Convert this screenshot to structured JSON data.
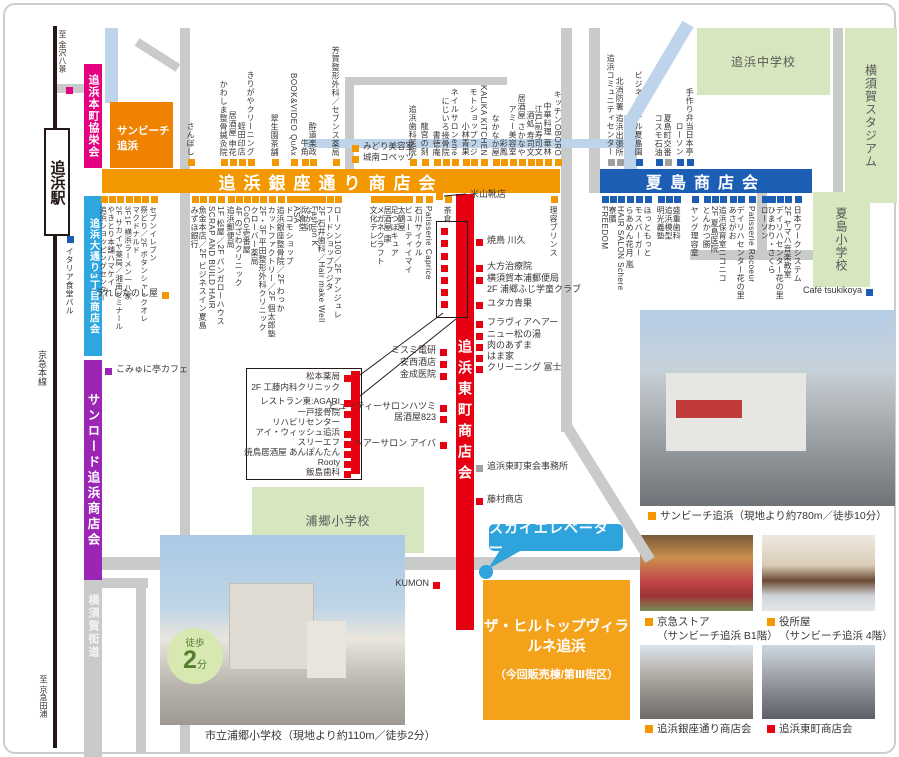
{
  "railway": {
    "dest_top": "至 金沢八景",
    "station": "追浜駅",
    "line": "京急本線",
    "dest_bottom": "至 京急田浦"
  },
  "banners": {
    "honcho": "追浜本町協栄会",
    "sunbeach_l1": "サンビーチ",
    "sunbeach_l2": "追浜",
    "ginza": "追浜銀座通り商店会",
    "natsushima": "夏島商店会",
    "odori": "追浜大通り3丁目商店会",
    "sunroad": "サンロード追浜商店会",
    "kaido": "横須賀街道",
    "higashicho": "追浜東町商店会"
  },
  "areas": {
    "junior_high": "追浜中学校",
    "stadium": "横須賀スタジアム",
    "natsushima_elem": "夏島小学校",
    "urago_elem": "浦郷小学校"
  },
  "callouts": {
    "sky_elevator": "スカイエレベーター",
    "property_l1": "ザ・ヒルトップヴィラ",
    "property_l2": "ルネ追浜",
    "property_l3": "（今回販売棟/第Ⅲ街区）"
  },
  "photos": {
    "main_caption": "サンビーチ追浜（現地より約780m／徒歩10分）",
    "keikyu_l1": "京急ストア",
    "keikyu_l2": "（サンビーチ追浜 B1階）",
    "yakusho_l1": "役所屋",
    "yakusho_l2": "（サンビーチ追浜 4階）",
    "ginza_caption": "追浜銀座通り商店会",
    "higashi_caption": "追浜東町商店会",
    "school_caption": "市立浦郷小学校（現地より約110m／徒歩2分）",
    "badge_walk": "徒歩",
    "badge_num": "2",
    "badge_min": "分"
  },
  "colors": {
    "ginza_orange": "#F39800",
    "natsushima_blue": "#1C5EB4",
    "higashicho_red": "#E60012",
    "odori_lightblue": "#2EA7E0",
    "sunroad_purple": "#9B26B5",
    "honcho_magenta": "#E4007F",
    "road_gray": "#C9CACA",
    "water_blue": "#BDD4EA",
    "school_green": "#D6E6BE",
    "callout_blue": "#2EA3DC",
    "property_orange": "#F5A21B",
    "marker_gray": "#9FA0A0"
  },
  "shop_groups": [
    {
      "id": "ginza-north",
      "type": "v-up",
      "sq": "#F39800",
      "fs": 8,
      "sq_y": 159,
      "text_y": 156,
      "items": [
        {
          "t": "さんぼし",
          "x": 188
        },
        {
          "t": "かわしま整骨鍼灸院",
          "x": 221
        },
        {
          "t": "居酒屋 申花",
          "x": 230
        },
        {
          "t": "蛭田印店",
          "x": 239
        },
        {
          "t": "きりがやクリーニング",
          "x": 248
        },
        {
          "t": "翠生園茶舗",
          "x": 272
        },
        {
          "t": "BOOK&VIDEO QuAx",
          "x": 291
        },
        {
          "t": "牛角",
          "x": 302
        },
        {
          "t": "酔道楽政",
          "x": 310
        },
        {
          "t": "芳賀整形外科／セブンス薬局",
          "x": 333
        },
        {
          "t": "追浜歯科医院",
          "x": 410
        },
        {
          "t": "龍宮の刻",
          "x": 422
        },
        {
          "t": "書徳庵",
          "x": 434
        },
        {
          "t": "にじいろ接骨院",
          "x": 443
        },
        {
          "t": "ネイルサロンeme",
          "x": 452
        },
        {
          "t": "小林青果",
          "x": 463
        },
        {
          "t": "モトショップフジ",
          "x": 471
        },
        {
          "t": "KALiKA KiTCHEN",
          "x": 481
        },
        {
          "t": "なかなか屋",
          "x": 493
        },
        {
          "t": "彩鳳",
          "x": 501
        },
        {
          "t": "アミー美容室",
          "x": 510
        },
        {
          "t": "居酒屋 さかなや",
          "x": 519
        },
        {
          "t": "酒処 寿司文",
          "x": 528
        },
        {
          "t": "江戸前寿司文",
          "x": 536
        },
        {
          "t": "中華料理 華林",
          "x": 545
        },
        {
          "t": "キッチンOBORO",
          "x": 555
        }
      ]
    },
    {
      "id": "natsushima-north",
      "type": "v-up",
      "sq": "#1C5EB4",
      "fs": 8,
      "sq_y": 159,
      "text_y": 156,
      "items": [
        {
          "t": "追浜コミュニティセンター",
          "x": 608,
          "c": "#9FA0A0"
        },
        {
          "t": "北消防署 追浜出張所",
          "x": 617,
          "c": "#9FA0A0"
        },
        {
          "t": "ビジネスホテル夏島園",
          "x": 636
        },
        {
          "t": "コスモ石油",
          "x": 656
        },
        {
          "t": "夏島町交番",
          "x": 665,
          "c": "#9FA0A0"
        },
        {
          "t": "ローソン",
          "x": 677
        },
        {
          "t": "手作り弁当日本亭",
          "x": 687
        }
      ]
    },
    {
      "id": "odori-south",
      "type": "v-down",
      "sq": "#F39800",
      "fs": 7.5,
      "sq_y": 196,
      "text_y": 206,
      "items": [
        {
          "t": "追浜ショッピングセンター",
          "x": 101
        },
        {
          "t": "やきとり本舗ハマケイ",
          "x": 109
        },
        {
          "t": "2F サカイヤ薬局／湘南ゼミナール",
          "x": 117
        },
        {
          "t": "3F1F 横浜ラーメン一八家",
          "x": 126
        },
        {
          "t": "マクドナルド",
          "x": 134
        },
        {
          "t": "祭どり／2F ボタンシャ・クオレ",
          "x": 142
        },
        {
          "t": "セブンイレブン",
          "x": 151
        }
      ]
    },
    {
      "id": "ginza-south",
      "type": "v-down",
      "sq": "#F39800",
      "fs": 8,
      "sq_y": 196,
      "text_y": 206,
      "items": [
        {
          "t": "みずほ銀行",
          "x": 192
        },
        {
          "t": "魚金本店／2F ビジネスイン夏島",
          "x": 200
        },
        {
          "t": "SCRAP AND BUILD HAIR",
          "x": 209
        },
        {
          "t": "1F 松屋／2F バンガローハウス",
          "x": 218
        },
        {
          "t": "追浜郵便局",
          "x": 228
        },
        {
          "t": "4F のざわクリニック",
          "x": 236
        },
        {
          "t": "CoCo壱番屋",
          "x": 244
        },
        {
          "t": "クローバー薬局",
          "x": 252
        },
        {
          "t": "2F・3F 平田整形外科クリニック",
          "x": 260
        },
        {
          "t": "カットファクトリー／2F 個太郎塾",
          "x": 269
        },
        {
          "t": "追浜銀座整骨院／2F わっか",
          "x": 278
        },
        {
          "t": "ドコモショップ",
          "x": 287
        },
        {
          "t": "ASA",
          "x": 294
        },
        {
          "t": "浜食堂",
          "x": 300
        },
        {
          "t": "なか卯",
          "x": 306
        },
        {
          "t": "Fashion K",
          "x": 312
        },
        {
          "t": "2F 石井歯科／Hair make Well",
          "x": 319
        },
        {
          "t": "フードショップフジタ",
          "x": 327
        },
        {
          "t": "ローソン100／2F アンジュレ",
          "x": 335
        },
        {
          "t": "文化テレビ",
          "x": 371
        },
        {
          "t": "メガネクラフト",
          "x": 378
        },
        {
          "t": "居酒屋 康",
          "x": 385
        },
        {
          "t": "足つぼキュア",
          "x": 392
        },
        {
          "t": "太鶴屋",
          "x": 399
        },
        {
          "t": "ビューティイマイ",
          "x": 406
        },
        {
          "t": "石川サイクル",
          "x": 416
        },
        {
          "t": "Patisserie Caprice",
          "x": 426
        },
        {
          "t": "茶倉",
          "x": 445
        },
        {
          "t": "理容プリンス",
          "x": 551
        }
      ]
    },
    {
      "id": "natsushima-south",
      "type": "v-down",
      "sq": "#1C5EB4",
      "fs": 8,
      "sq_y": 196,
      "text_y": 206,
      "items": [
        {
          "t": "FREEDOM",
          "x": 602
        },
        {
          "t": "寮膳",
          "x": 610
        },
        {
          "t": "HAIR SALON Schere",
          "x": 618
        },
        {
          "t": "らあめん花月 嵐",
          "x": 627
        },
        {
          "t": "モスバーガー",
          "x": 636
        },
        {
          "t": "ほっともっと",
          "x": 645
        },
        {
          "t": "明光義塾",
          "x": 658
        },
        {
          "t": "追浜模型",
          "x": 666
        },
        {
          "t": "盛重歯科",
          "x": 674
        },
        {
          "t": "ヤング理容室",
          "x": 692
        },
        {
          "t": "とんかつ勝",
          "x": 704
        },
        {
          "t": "2F 夏島医院",
          "x": 712
        },
        {
          "t": "追浜保育室ニコニコ",
          "x": 720
        },
        {
          "t": "あさがお",
          "x": 730
        },
        {
          "t": "デイリハセンター花の里",
          "x": 738
        },
        {
          "t": "Patisserie Rocoeur",
          "x": 749
        },
        {
          "t": "ローソン",
          "x": 762
        },
        {
          "t": "ひまわり・さくら",
          "x": 769
        },
        {
          "t": "デイリハセンター花の里",
          "x": 777
        },
        {
          "t": "2F ヤマハ音楽教室",
          "x": 785
        },
        {
          "t": "日本ワークシステム",
          "x": 795
        }
      ]
    },
    {
      "id": "higashicho-east",
      "type": "h-left",
      "sq": "#E60012",
      "sqx": 476,
      "fs": 9,
      "items": [
        {
          "t": "焼鳥 川久",
          "y": 238
        },
        {
          "t": "大方治療院",
          "y": 264
        },
        {
          "t": "横須賀本浦郵便局",
          "y": 276
        },
        {
          "t": "2F 浦郷ふじ学童クラブ",
          "y": 287,
          "nosq": true
        },
        {
          "t": "ユタカ青果",
          "y": 301
        },
        {
          "t": "フラヴィアヘアー",
          "y": 320
        },
        {
          "t": "ニュー松の湯",
          "y": 332
        },
        {
          "t": "肉のあずま",
          "y": 343
        },
        {
          "t": "はま家",
          "y": 354
        },
        {
          "t": "クリーニング 冨士",
          "y": 365
        },
        {
          "t": "追浜東町東会事務所",
          "y": 464,
          "c": "#9FA0A0"
        },
        {
          "t": "藤村商店",
          "y": 497
        }
      ]
    },
    {
      "id": "higashicho-west",
      "type": "h-right",
      "sq": "#E60012",
      "sqx": 440,
      "fs": 9,
      "items": [
        {
          "t": "ミスミ電研",
          "y": 348
        },
        {
          "t": "安西酒店",
          "y": 360
        },
        {
          "t": "金成医院",
          "y": 372
        },
        {
          "t": "ビューティーサロンハツミ",
          "y": 404
        },
        {
          "t": "居酒屋823",
          "y": 415
        },
        {
          "t": "ヘアーサロン アイバ",
          "y": 441
        },
        {
          "t": "KUMON",
          "y": 581,
          "sqx": 433
        }
      ]
    },
    {
      "id": "building-box",
      "type": "h-right",
      "sq": "#E60012",
      "sqx": 344,
      "fs": 8.5,
      "items": [
        {
          "t": "松本薬局",
          "y": 374
        },
        {
          "t": "2F 工藤内科クリニック",
          "y": 385,
          "nosq": true
        },
        {
          "t": "レストラン東:AGARI",
          "y": 399
        },
        {
          "t": "一戸接骨院",
          "y": 410
        },
        {
          "t": "リハビリセンター",
          "y": 420,
          "nosq": true
        },
        {
          "t": "アイ・ウィッシュ追浜",
          "y": 430
        },
        {
          "t": "スリーエフ",
          "y": 440
        },
        {
          "t": "焼鳥居酒屋 あんぽんたん",
          "y": 450
        },
        {
          "t": "Rooty",
          "y": 460
        },
        {
          "t": "飯島歯科",
          "y": 470
        }
      ]
    },
    {
      "id": "misc-italian",
      "type": "v-down",
      "sq": "#1C5EB4",
      "fs": 8,
      "sq_y": 236,
      "text_y": 247,
      "items": [
        {
          "t": "イタリア食堂バル",
          "x": 67
        }
      ]
    },
    {
      "id": "misc-cafe",
      "type": "h-left",
      "sq": "#9B26B5",
      "sqx": 105,
      "fs": 9,
      "items": [
        {
          "t": "こみゅに亭カフェ",
          "y": 367
        }
      ]
    },
    {
      "id": "misc-ureshi",
      "type": "h-right",
      "sq": "#F39800",
      "sqx": 162,
      "fs": 9,
      "items": [
        {
          "t": "うれしたのし屋",
          "y": 291
        }
      ]
    },
    {
      "id": "misc-yoneyama",
      "type": "h-left",
      "sq": "#F39800",
      "sqx": 436,
      "tx": 470,
      "fs": 9,
      "items": [
        {
          "t": "米山靴店",
          "y": 192
        }
      ]
    },
    {
      "id": "misc-tsukikoya",
      "type": "h-right",
      "sq": "#1C5EB4",
      "sqx": 866,
      "fs": 9,
      "items": [
        {
          "t": "Café tsukikoya",
          "y": 288
        }
      ]
    },
    {
      "id": "misc-midori",
      "type": "h-left",
      "sq": "#F39800",
      "sqx": 352,
      "fs": 8.5,
      "items": [
        {
          "t": "みどり美容室",
          "y": 144
        },
        {
          "t": "城南コペッツ",
          "y": 155
        }
      ]
    },
    {
      "id": "bldg-markers",
      "type": "markers",
      "sq": "#E60012",
      "items": [
        {
          "x": 441,
          "y": 228
        },
        {
          "x": 441,
          "y": 240
        },
        {
          "x": 441,
          "y": 253
        },
        {
          "x": 441,
          "y": 265
        },
        {
          "x": 441,
          "y": 277
        },
        {
          "x": 441,
          "y": 289
        },
        {
          "x": 441,
          "y": 301
        },
        {
          "x": 66,
          "y": 87,
          "c": "#E4007F"
        }
      ]
    }
  ]
}
